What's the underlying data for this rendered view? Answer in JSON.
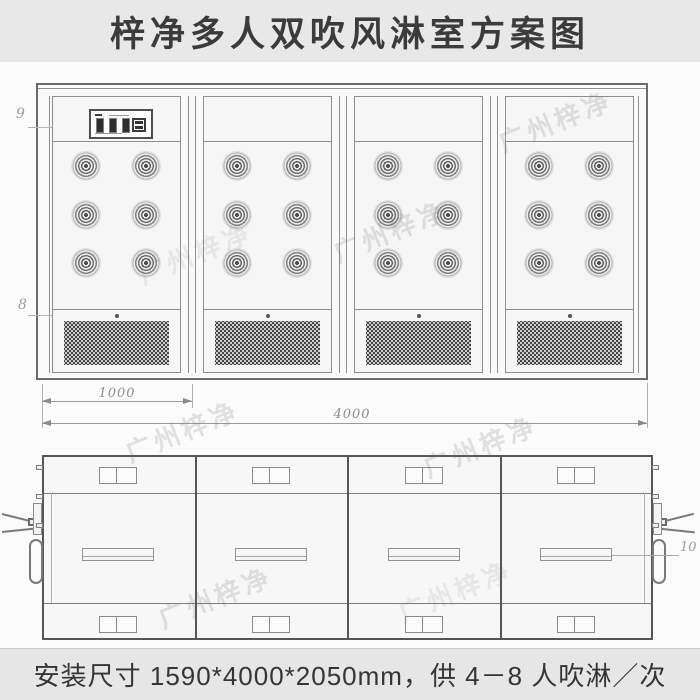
{
  "title_bar": {
    "title": "梓净多人双吹风淋室方案图"
  },
  "footer_bar": {
    "text": "安装尺寸 1590*4000*2050mm，供 4－8 人吹淋／次"
  },
  "watermark": {
    "text": "广州梓净"
  },
  "front_view": {
    "description": "front elevation of 4-door air shower with double-blow nozzles",
    "module_count": 4,
    "nozzle_rows": 3,
    "nozzle_cols": 2,
    "callouts": [
      {
        "id": "9",
        "target": "control-panel"
      },
      {
        "id": "8",
        "target": "air-return-grille"
      }
    ],
    "dimensions": [
      {
        "label": "1000"
      },
      {
        "label": "4000"
      }
    ]
  },
  "plan_view": {
    "description": "top plan view with door closers, handles, filter boxes and lights",
    "module_count": 4,
    "callouts": [
      {
        "id": "10",
        "target": "light-fixture"
      }
    ]
  },
  "colors": {
    "title_bar_bg": "#e8e8e8",
    "footer_bar_bg": "#e6e6e6",
    "canvas_bg": "#fbfbfb",
    "frame_line": "#6a6a6a",
    "thin_line": "#8f8f8f",
    "text": "#3b3b3b",
    "callout_text": "#9b9b9b",
    "grille_dot": "#3d3d3d",
    "watermark": "rgba(120,120,120,0.20)"
  }
}
